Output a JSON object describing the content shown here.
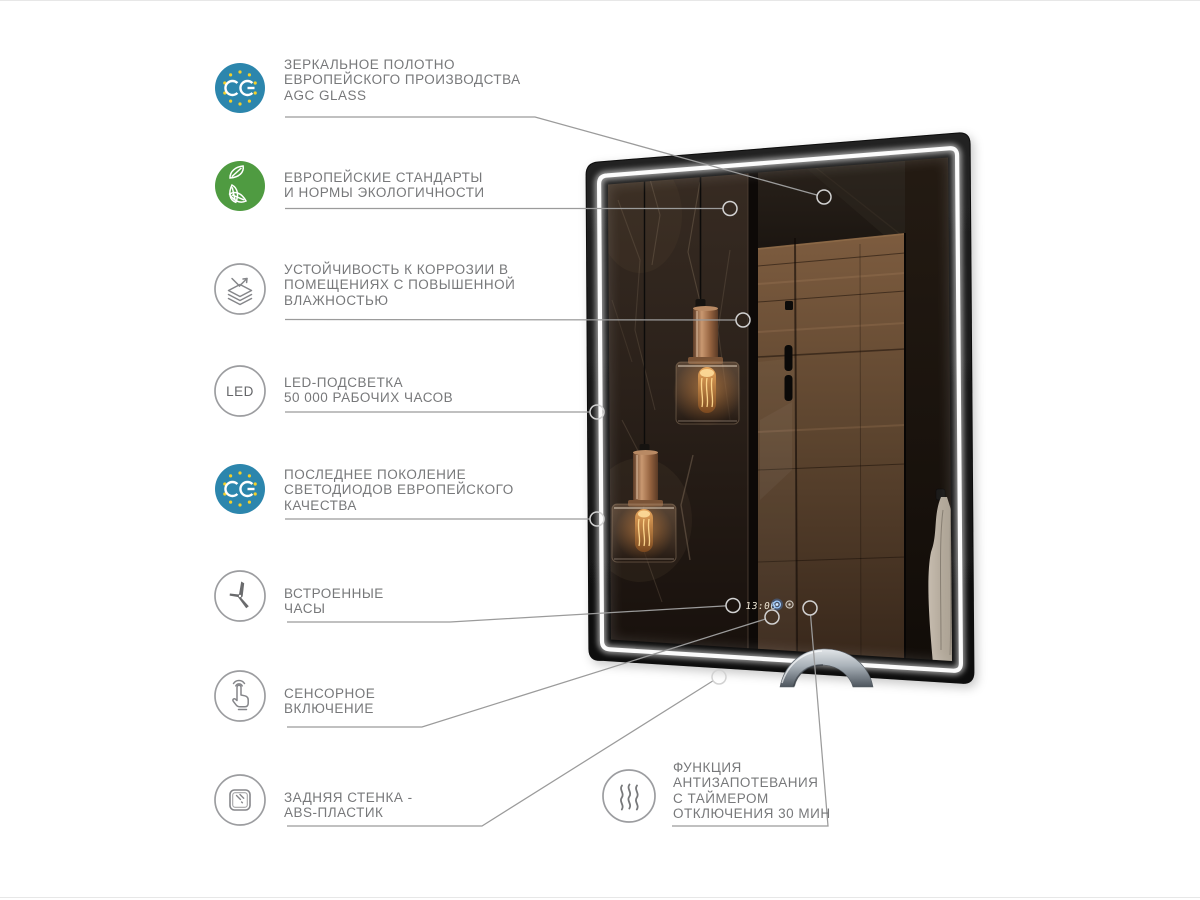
{
  "page": {
    "background": "#ffffff"
  },
  "colors": {
    "ce_blue": "#2c86ad",
    "star_yellow": "#f3d02b",
    "eco_green": "#4f9b41",
    "line_grey": "#9b9b9b",
    "ring_grey": "#d2d2d2",
    "text_grey": "#77787a",
    "icon_outline": "#9c9da0",
    "icon_glyph": "#85868a",
    "led_strip_white": "#ffffff",
    "clock_digits": "#f2ead8",
    "power_button_blue": "#9fccff"
  },
  "features": [
    {
      "id": "mirror-glass",
      "icon": "ce-mark-icon",
      "lines": [
        "ЗЕРКАЛЬНОЕ  ПОЛОТНО",
        "ЕВРОПЕЙСКОГО ПРОИЗВОДСТВА",
        "AGC GLASS"
      ]
    },
    {
      "id": "eco-standards",
      "icon": "eco-leaves-icon",
      "lines": [
        "ЕВРОПЕЙСКИЕ СТАНДАРТЫ",
        "И НОРМЫ ЭКОЛОГИЧНОСТИ"
      ]
    },
    {
      "id": "corrosion-resistance",
      "icon": "layers-corrosion-icon",
      "lines": [
        "УСТОЙЧИВОСТЬ К КОРРОЗИИ В",
        "ПОМЕЩЕНИЯХ С ПОВЫШЕННОЙ",
        "ВЛАЖНОСТЬЮ"
      ]
    },
    {
      "id": "led-backlight",
      "icon": "led-text-icon",
      "lines": [
        "LED-ПОДСВЕТКА",
        "50 000 РАБОЧИХ ЧАСОВ"
      ]
    },
    {
      "id": "led-generation",
      "icon": "ce-mark-icon",
      "lines": [
        "ПОСЛЕДНЕЕ ПОКОЛЕНИЕ",
        "СВЕТОДИОДОВ ЕВРОПЕЙСКОГО",
        "КАЧЕСТВА"
      ]
    },
    {
      "id": "built-in-clock",
      "icon": "clock-icon",
      "lines": [
        "ВСТРОЕННЫЕ",
        "ЧАСЫ"
      ]
    },
    {
      "id": "touch-switch",
      "icon": "touch-icon",
      "lines": [
        "СЕНСОРНОЕ",
        "ВКЛЮЧЕНИЕ"
      ]
    },
    {
      "id": "back-panel",
      "icon": "back-panel-icon",
      "lines": [
        "ЗАДНЯЯ СТЕНКА -",
        "ABS-ПЛАСТИК"
      ]
    },
    {
      "id": "antifog",
      "icon": "heat-waves-icon",
      "lines": [
        "ФУНКЦИЯ",
        "АНТИЗАПОТЕВАНИЯ",
        "С ТАЙМЕРОМ",
        "ОТКЛЮЧЕНИЯ 30 МИН"
      ]
    }
  ],
  "icons": {
    "led_label": "LED"
  },
  "mirror": {
    "clock_time": "13:06"
  }
}
